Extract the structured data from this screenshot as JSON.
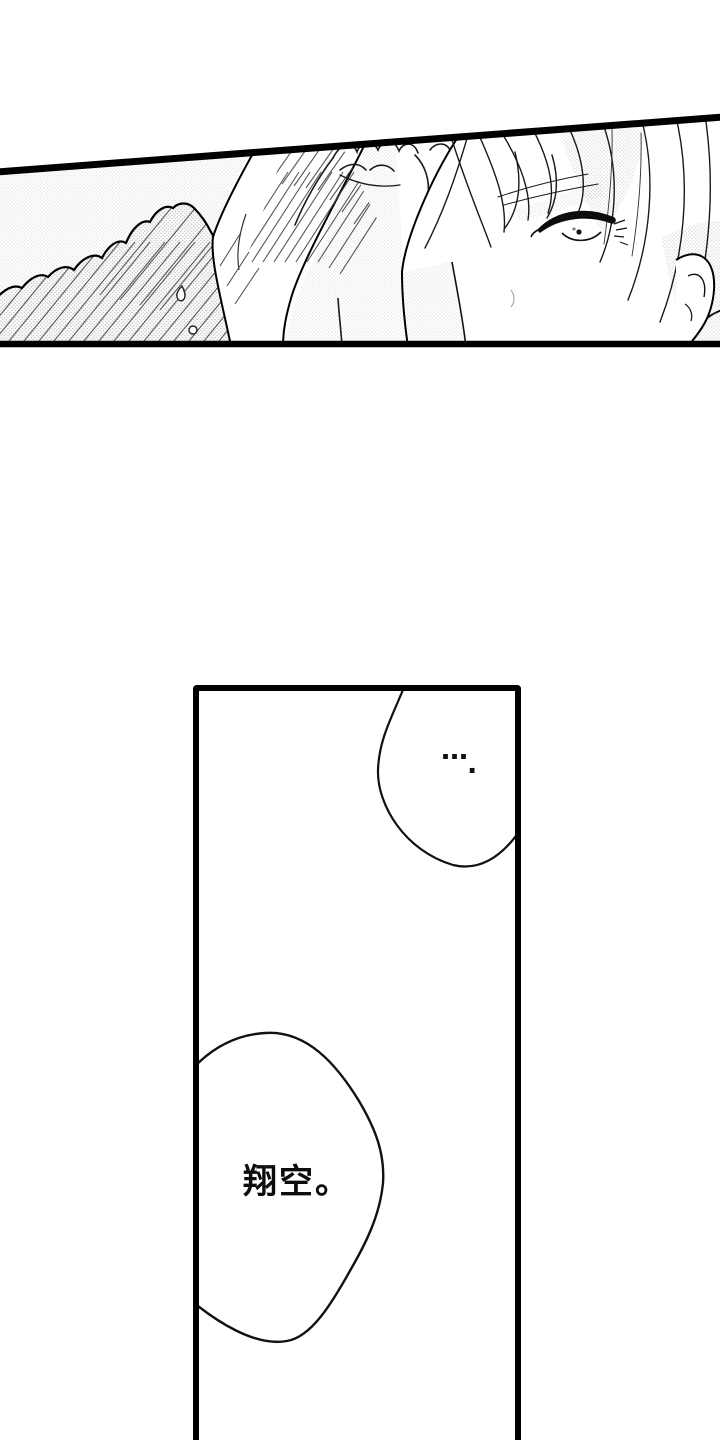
{
  "page": {
    "colors": {
      "ink": "#000000",
      "paper": "#ffffff",
      "tone_gray": "#9a9a9a"
    }
  },
  "bottom_panel": {
    "ellipsis_bubble": {
      "dots": "…",
      "period": "."
    },
    "name_bubble": {
      "text": "翔空。"
    }
  }
}
